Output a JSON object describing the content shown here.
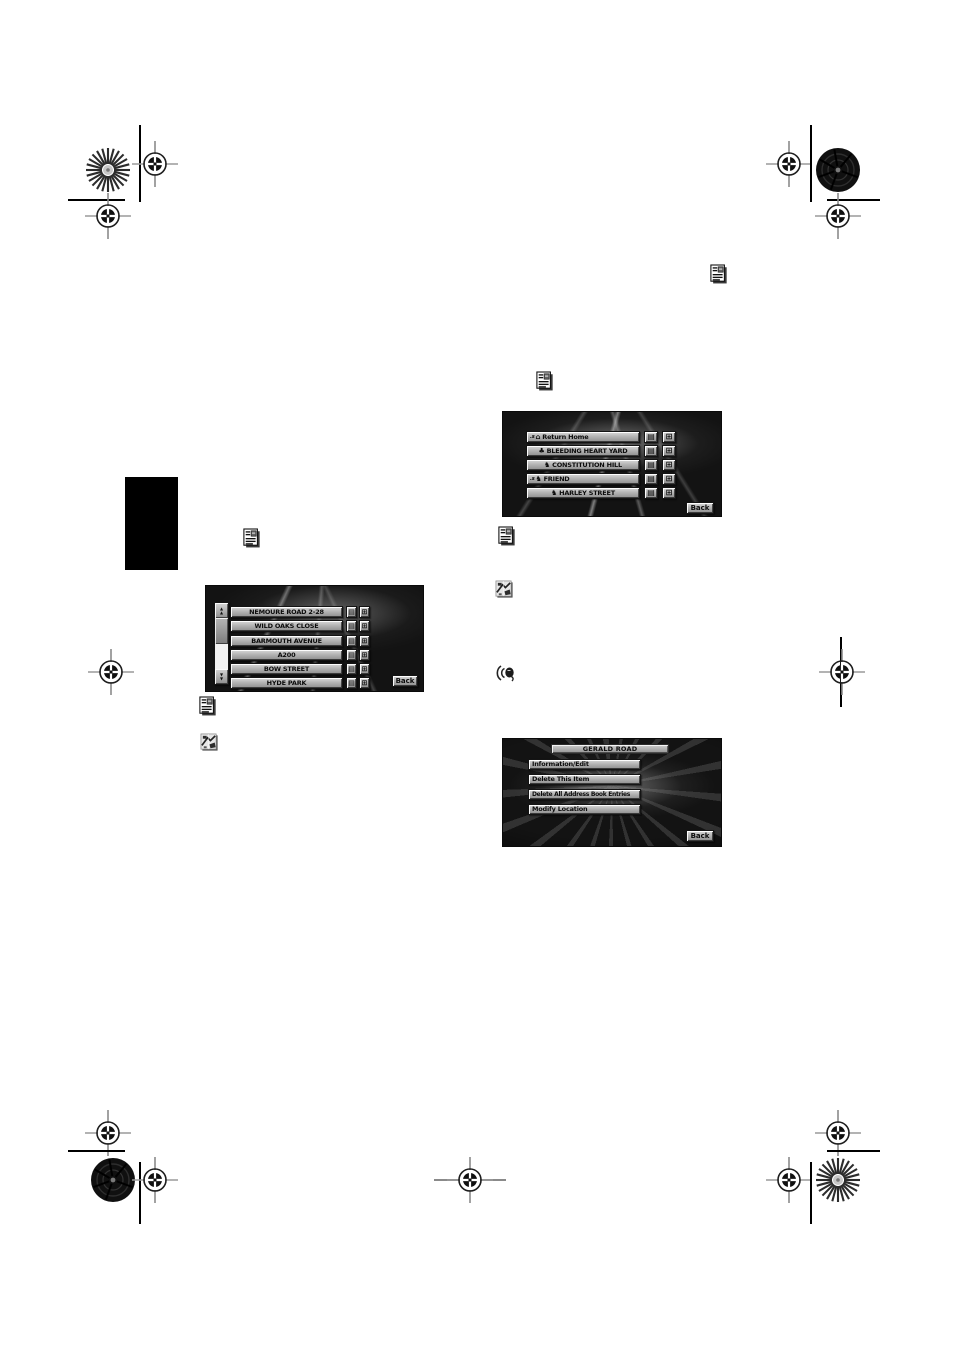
{
  "document": {
    "kind": "printed-manual-page",
    "page_bg": "#ffffff"
  },
  "colors": {
    "screen_bg": "#131313",
    "button_face": "#b4b4b4",
    "screen_text": "#0c0c0c",
    "tab_color": "#000000"
  },
  "glyphs": {
    "home": "⌂",
    "flower": "♣",
    "poi": "♞",
    "detail": "▤",
    "map": "⊞",
    "up": "▲",
    "down": "▼"
  },
  "inline_icons": {
    "note": "document-note-icon",
    "map": "map-fragment-icon",
    "voice": "voice-operation-icon"
  },
  "screens": {
    "address_book": {
      "voice_tag": ".s",
      "rows": [
        {
          "label": "Return Home"
        },
        {
          "label": "BLEEDING HEART YARD"
        },
        {
          "label": "CONSTITUTION HILL"
        },
        {
          "label": "FRIEND"
        },
        {
          "label": "HARLEY STREET"
        }
      ],
      "back_label": "Back"
    },
    "street_list": {
      "rows": [
        {
          "label": "NEMOURE ROAD 2-28"
        },
        {
          "label": "WILD OAKS CLOSE"
        },
        {
          "label": "BARMOUTH AVENUE"
        },
        {
          "label": "A200"
        },
        {
          "label": "BOW STREET"
        },
        {
          "label": "HYDE PARK"
        }
      ],
      "back_label": "Back"
    },
    "edit_menu": {
      "title": "GERALD ROAD",
      "items": [
        {
          "label": "Information/Edit"
        },
        {
          "label": "Delete This Item"
        },
        {
          "label": "Delete All Address Book Entries"
        },
        {
          "label": "Modify Location"
        }
      ],
      "back_label": "Back"
    }
  }
}
